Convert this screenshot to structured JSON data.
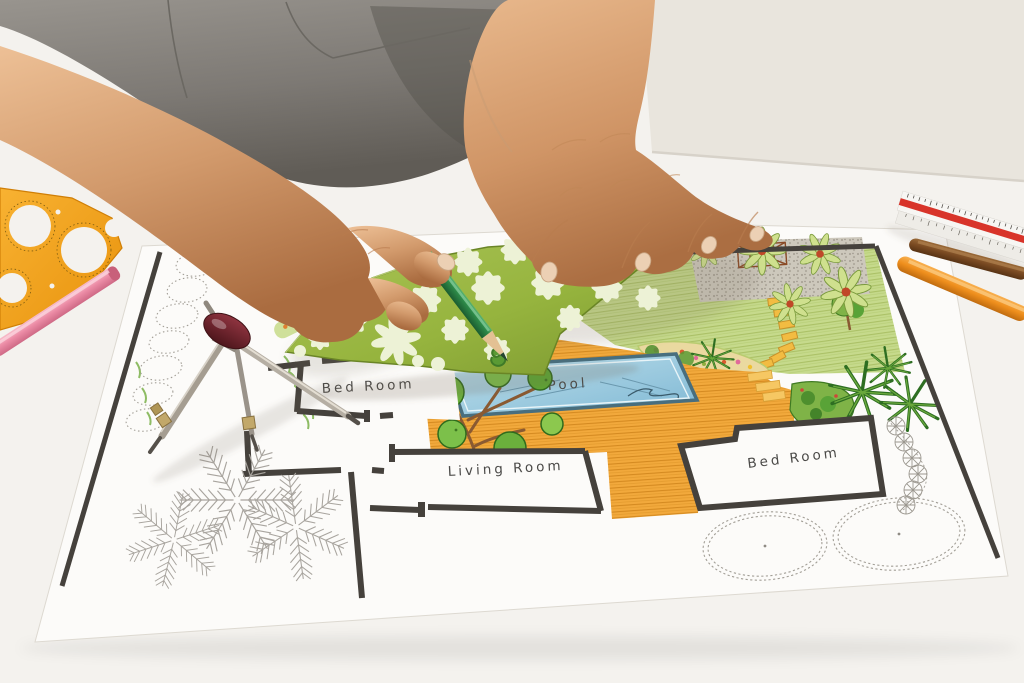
{
  "scene": {
    "description": "Overhead photo of a landscape architect's hands drawing a backyard garden design plan on a white desk, tracing tree shapes through a green stencil with a green pencil",
    "objects": [
      "gray-shirt-torso",
      "left-hand-holding-pencil",
      "right-hand-pressing-stencil",
      "green-tree-stencil",
      "green-pencil",
      "compass-divider-tool",
      "orange-circle-template",
      "pink-pencil",
      "triangular-scale-ruler",
      "brown-pencil",
      "orange-pencil",
      "garden-plan-drawing"
    ]
  },
  "plan": {
    "labels": {
      "bedroom_left": "Bed Room",
      "living_room": "Living Room",
      "pool": "Pool",
      "bedroom_right": "Bed Room"
    },
    "features": [
      "swimming-pool",
      "wood-deck",
      "lawn",
      "gravel-patio",
      "stepping-stone-path",
      "flower-beds",
      "palm-clusters",
      "bonsai-trees",
      "sketched-shrub-circles",
      "sketched-fern-plants",
      "pinwheel-shrub-symbols"
    ]
  },
  "colors": {
    "wall": "#e9e5dd",
    "desk": "#f4f2ee",
    "paper": "#fcfbf9",
    "wall-line": "#45413c",
    "label-ink": "#4b4a48",
    "shirt-gray": "#837f79",
    "skin": "#d9a070",
    "stencil-green": "#96b43e",
    "stencil-cutout": "#edf2d6",
    "lawn-green": "#c6da8c",
    "deck-orange": "#f2a93c",
    "pool-blue": "#8ec4dc",
    "pencil-green": "#2e8b49",
    "pencil-pink": "#ec8ca6",
    "pencil-orange": "#ef8f1d",
    "pencil-brown": "#7a4a22",
    "template-orange": "#f6a41e",
    "ruler-red": "#d8342a",
    "compass-maroon": "#6e2228",
    "metal": "#a59d91",
    "sketch-gray": "#a29e96",
    "foliage-dark": "#2f6b25",
    "foliage-mid": "#6bb03c",
    "foliage-light": "#9acb55"
  }
}
